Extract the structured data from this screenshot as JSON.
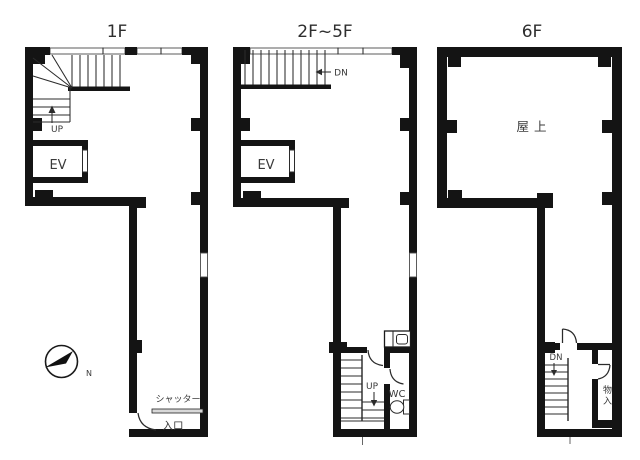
{
  "document": {
    "background": "#ffffff"
  },
  "colors": {
    "wall": "#141414",
    "line": "#2b2b2b",
    "label_text": "#3a3a3a",
    "shutter_fill": "#d8d8d8"
  },
  "plans": [
    {
      "id": "1F",
      "title": "1F",
      "labels": {
        "up": "UP",
        "elevator": "EV",
        "shutter": "シャッター",
        "entrance": "入口"
      }
    },
    {
      "id": "2F-5F",
      "title": "2F~5F",
      "labels": {
        "down": "DN",
        "elevator": "EV",
        "up": "UP",
        "toilet": "WC"
      }
    },
    {
      "id": "6F",
      "title": "6F",
      "labels": {
        "rooftop": "屋上",
        "down": "DN",
        "storage": "物入",
        "storage_chars": [
          "物",
          "入"
        ]
      }
    }
  ],
  "compass": {
    "label": "N"
  }
}
